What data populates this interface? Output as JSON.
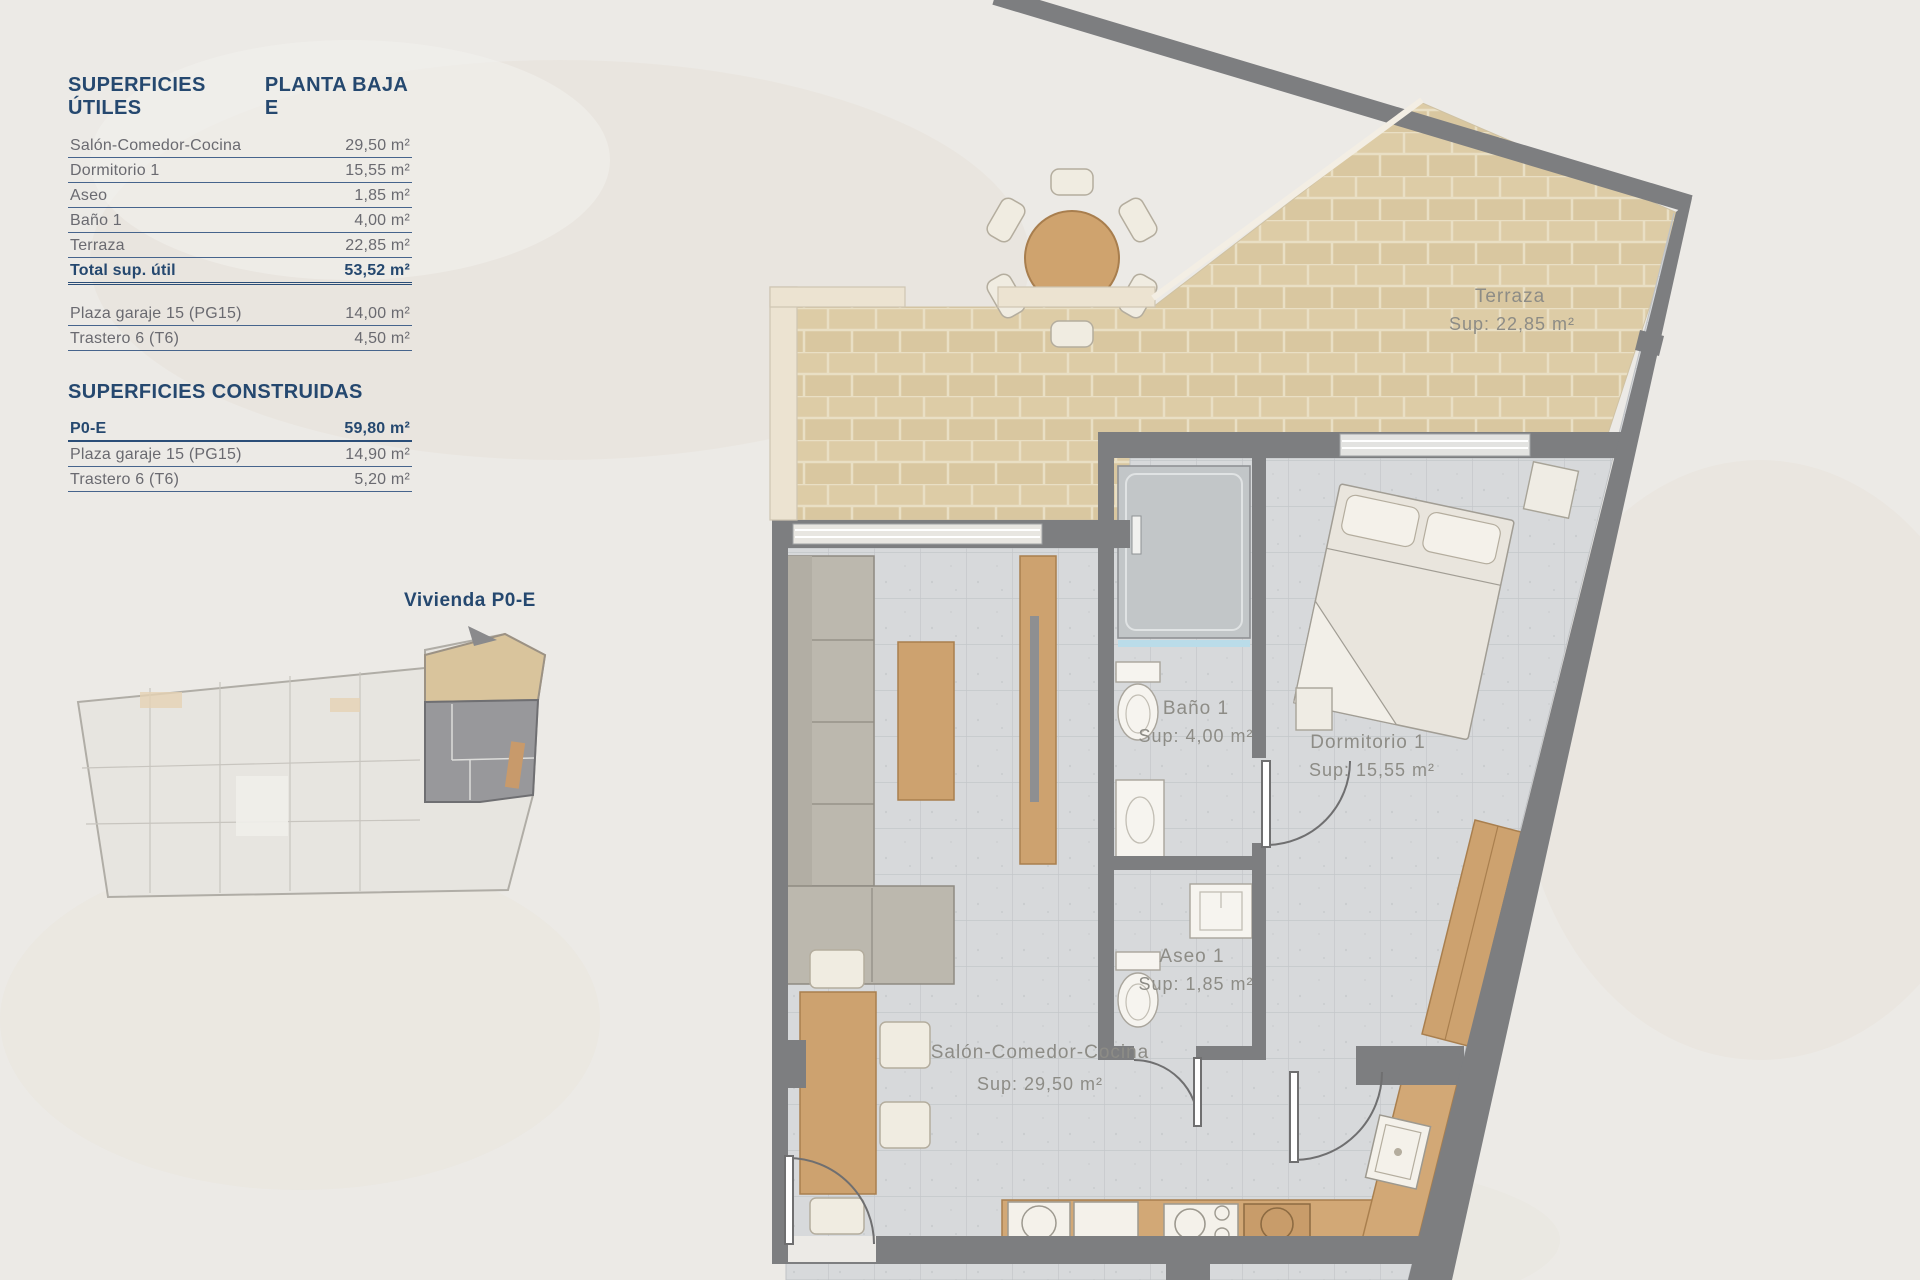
{
  "panel": {
    "title_left": "SUPERFICIES ÚTILES",
    "title_right": "PLANTA BAJA E",
    "useful_rows": [
      {
        "label": "Salón-Comedor-Cocina",
        "value": "29,50 m²"
      },
      {
        "label": "Dormitorio 1",
        "value": "15,55 m²"
      },
      {
        "label": "Aseo",
        "value": "1,85 m²"
      },
      {
        "label": "Baño 1",
        "value": "4,00 m²"
      },
      {
        "label": "Terraza",
        "value": "22,85 m²"
      }
    ],
    "total_row": {
      "label": "Total sup. útil",
      "value": "53,52 m²"
    },
    "extra_rows": [
      {
        "label": "Plaza garaje 15 (PG15)",
        "value": "14,00 m²"
      },
      {
        "label": "Trastero 6 (T6)",
        "value": "4,50 m²"
      }
    ],
    "built_title": "SUPERFICIES CONSTRUIDAS",
    "built_rows": [
      {
        "label": "P0-E",
        "value": "59,80 m²",
        "emphasis": true
      },
      {
        "label": "Plaza garaje 15 (PG15)",
        "value": "14,90 m²"
      },
      {
        "label": "Trastero 6 (T6)",
        "value": "5,20 m²"
      }
    ],
    "keyplan_label": "Vivienda P0-E"
  },
  "plan": {
    "rooms": [
      {
        "name": "Terraza",
        "sup": "Sup: 22,85 m²"
      },
      {
        "name": "Baño 1",
        "sup": "Sup: 4,00 m²"
      },
      {
        "name": "Dormitorio 1",
        "sup": "Sup: 15,55 m²"
      },
      {
        "name": "Aseo 1",
        "sup": "Sup: 1,85 m²"
      },
      {
        "name": "Salón-Comedor-Cocina",
        "sup": "Sup: 29,50 m²"
      }
    ]
  },
  "colors": {
    "accent_navy": "#25486f",
    "wall_gray": "#7d7e80",
    "terrace_tile": "#d9c7a0",
    "interior_tile": "#d7d9db",
    "wood": "#cda26f",
    "background": "#eceae6"
  }
}
